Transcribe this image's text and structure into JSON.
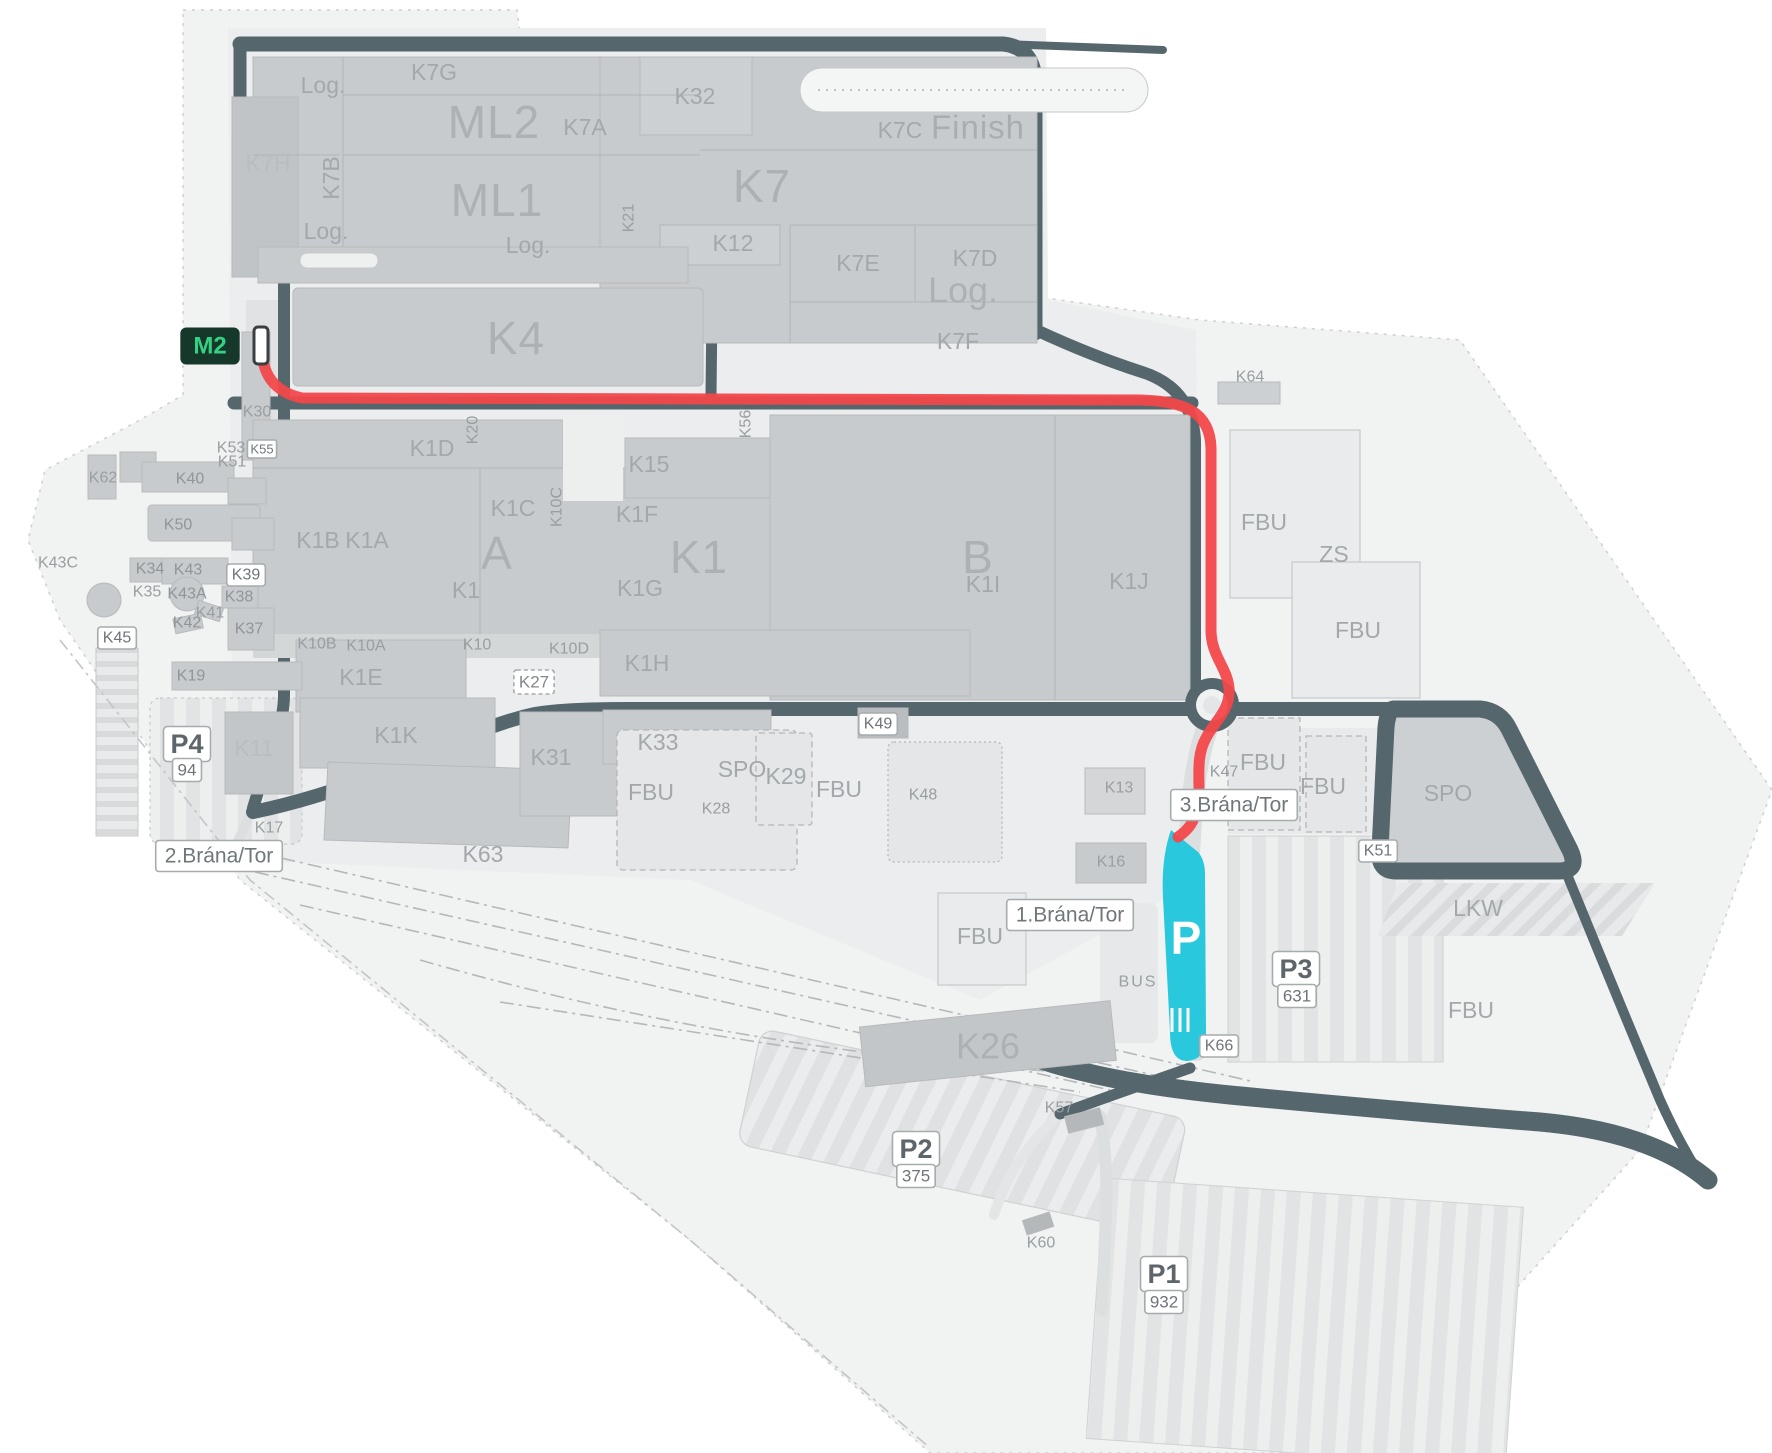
{
  "map": {
    "name": "factory-site-map",
    "colors": {
      "route_red": "#f2484b",
      "parking_cyan": "#29c8dd",
      "m2_badge_bg": "#16382b",
      "m2_badge_text": "#35d183",
      "road_dark": "#55666c",
      "building_gray": "#c8cbcd",
      "label_gray": "#9aa0a3"
    },
    "badges": {
      "station": "M2",
      "parking_letter": "P"
    },
    "gates": [
      "1.Brána/Tor",
      "2.Brána/Tor",
      "3.Brána/Tor"
    ],
    "parking_counts": {
      "P1": "932",
      "P2": "375",
      "P3": "631",
      "P4": "94"
    },
    "labels": [
      {
        "id": "label-log-topleft",
        "text": "Log.",
        "x": 323,
        "y": 85,
        "cls": "md"
      },
      {
        "id": "label-k7g",
        "text": "K7G",
        "x": 434,
        "y": 72,
        "cls": "md"
      },
      {
        "id": "label-ml2",
        "text": "ML2",
        "x": 494,
        "y": 122,
        "cls": "big"
      },
      {
        "id": "label-k7a",
        "text": "K7A",
        "x": 585,
        "y": 127,
        "cls": "md"
      },
      {
        "id": "label-k32",
        "text": "K32",
        "x": 695,
        "y": 96,
        "cls": "md"
      },
      {
        "id": "label-k7c",
        "text": "K7C",
        "x": 900,
        "y": 130,
        "cls": "md"
      },
      {
        "id": "label-finish",
        "text": "Finish",
        "x": 978,
        "y": 127,
        "cls": "finish"
      },
      {
        "id": "label-k7h",
        "text": "K7H",
        "x": 268,
        "y": 163,
        "cls": "mdl"
      },
      {
        "id": "label-k7b",
        "text": "K7B",
        "x": 331,
        "y": 178,
        "cls": "md",
        "rot": -90
      },
      {
        "id": "label-ml1",
        "text": "ML1",
        "x": 497,
        "y": 200,
        "cls": "big"
      },
      {
        "id": "label-k7",
        "text": "K7",
        "x": 762,
        "y": 186,
        "cls": "big"
      },
      {
        "id": "label-log-midleft",
        "text": "Log.",
        "x": 326,
        "y": 231,
        "cls": "md"
      },
      {
        "id": "label-log-center",
        "text": "Log.",
        "x": 528,
        "y": 245,
        "cls": "md"
      },
      {
        "id": "label-k21",
        "text": "K21",
        "x": 629,
        "y": 218,
        "cls": "sm",
        "rot": -90
      },
      {
        "id": "label-k12",
        "text": "K12",
        "x": 733,
        "y": 243,
        "cls": "md"
      },
      {
        "id": "label-k7e",
        "text": "K7E",
        "x": 858,
        "y": 263,
        "cls": "md"
      },
      {
        "id": "label-k7d",
        "text": "K7D",
        "x": 975,
        "y": 258,
        "cls": "md"
      },
      {
        "id": "label-log-k7d",
        "text": "Log.",
        "x": 963,
        "y": 290,
        "cls": "big2"
      },
      {
        "id": "label-k7f",
        "text": "K7F",
        "x": 958,
        "y": 341,
        "cls": "md"
      },
      {
        "id": "badge-m2",
        "text": "M2",
        "x": 210,
        "y": 346,
        "cls": "m2"
      },
      {
        "id": "label-k4",
        "text": "K4",
        "x": 516,
        "y": 338,
        "cls": "big"
      },
      {
        "id": "label-k30",
        "text": "K30",
        "x": 257,
        "y": 412,
        "cls": "sm"
      },
      {
        "id": "label-k53",
        "text": "K53",
        "x": 231,
        "y": 448,
        "cls": "sm"
      },
      {
        "id": "label-k55",
        "text": "K55",
        "x": 262,
        "y": 449,
        "cls": "pillTiny"
      },
      {
        "id": "label-k51-left",
        "text": "K51",
        "x": 232,
        "y": 462,
        "cls": "sm"
      },
      {
        "id": "label-k64",
        "text": "K64",
        "x": 1250,
        "y": 377,
        "cls": "sm"
      },
      {
        "id": "label-k1d",
        "text": "K1D",
        "x": 432,
        "y": 448,
        "cls": "md"
      },
      {
        "id": "label-k20",
        "text": "K20",
        "x": 473,
        "y": 430,
        "cls": "sm",
        "rot": -90
      },
      {
        "id": "label-k15",
        "text": "K15",
        "x": 649,
        "y": 464,
        "cls": "md"
      },
      {
        "id": "label-k56",
        "text": "K56",
        "x": 746,
        "y": 424,
        "cls": "sm",
        "rot": -90
      },
      {
        "id": "label-k1b",
        "text": "K1B",
        "x": 318,
        "y": 540,
        "cls": "md"
      },
      {
        "id": "label-k1a",
        "text": "K1A",
        "x": 367,
        "y": 540,
        "cls": "md"
      },
      {
        "id": "label-k1c",
        "text": "K1C",
        "x": 513,
        "y": 508,
        "cls": "md"
      },
      {
        "id": "label-k10c",
        "text": "K10C",
        "x": 557,
        "y": 507,
        "cls": "sm",
        "rot": -90
      },
      {
        "id": "label-k1f",
        "text": "K1F",
        "x": 637,
        "y": 514,
        "cls": "md"
      },
      {
        "id": "label-a",
        "text": "A",
        "x": 497,
        "y": 553,
        "cls": "big"
      },
      {
        "id": "label-k1-sub",
        "text": "K1",
        "x": 466,
        "y": 590,
        "cls": "md"
      },
      {
        "id": "label-k1-big",
        "text": "K1",
        "x": 699,
        "y": 557,
        "cls": "big"
      },
      {
        "id": "label-k1g",
        "text": "K1G",
        "x": 640,
        "y": 588,
        "cls": "md"
      },
      {
        "id": "label-b",
        "text": "B",
        "x": 978,
        "y": 557,
        "cls": "big"
      },
      {
        "id": "label-k1i",
        "text": "K1I",
        "x": 983,
        "y": 584,
        "cls": "md"
      },
      {
        "id": "label-k1j",
        "text": "K1J",
        "x": 1129,
        "y": 581,
        "cls": "md"
      },
      {
        "id": "label-k10b",
        "text": "K10B",
        "x": 317,
        "y": 644,
        "cls": "sm"
      },
      {
        "id": "label-k10a",
        "text": "K10A",
        "x": 366,
        "y": 646,
        "cls": "sm"
      },
      {
        "id": "label-k10",
        "text": "K10",
        "x": 477,
        "y": 645,
        "cls": "sm"
      },
      {
        "id": "label-k10d",
        "text": "K10D",
        "x": 569,
        "y": 649,
        "cls": "sm"
      },
      {
        "id": "label-k1h",
        "text": "K1H",
        "x": 647,
        "y": 663,
        "cls": "md"
      },
      {
        "id": "label-k1e",
        "text": "K1E",
        "x": 361,
        "y": 677,
        "cls": "md"
      },
      {
        "id": "label-k27",
        "text": "K27",
        "x": 534,
        "y": 682,
        "cls": "pillDash"
      },
      {
        "id": "label-k1k",
        "text": "K1K",
        "x": 396,
        "y": 735,
        "cls": "md"
      },
      {
        "id": "label-k62",
        "text": "K62",
        "x": 103,
        "y": 478,
        "cls": "sm"
      },
      {
        "id": "label-k40",
        "text": "K40",
        "x": 190,
        "y": 479,
        "cls": "smD"
      },
      {
        "id": "label-k50",
        "text": "K50",
        "x": 178,
        "y": 525,
        "cls": "smD"
      },
      {
        "id": "label-k43c",
        "text": "K43C",
        "x": 58,
        "y": 563,
        "cls": "sm"
      },
      {
        "id": "label-k34",
        "text": "K34",
        "x": 150,
        "y": 569,
        "cls": "smD"
      },
      {
        "id": "label-k43",
        "text": "K43",
        "x": 188,
        "y": 570,
        "cls": "smD"
      },
      {
        "id": "label-k35",
        "text": "K35",
        "x": 147,
        "y": 592,
        "cls": "sm"
      },
      {
        "id": "label-k43a",
        "text": "K43A",
        "x": 187,
        "y": 594,
        "cls": "smD"
      },
      {
        "id": "label-k39",
        "text": "K39",
        "x": 246,
        "y": 575,
        "cls": "pillSm"
      },
      {
        "id": "label-k38",
        "text": "K38",
        "x": 239,
        "y": 597,
        "cls": "smD"
      },
      {
        "id": "label-k41",
        "text": "K41",
        "x": 210,
        "y": 613,
        "cls": "sm"
      },
      {
        "id": "label-k42",
        "text": "K42",
        "x": 187,
        "y": 623,
        "cls": "smD"
      },
      {
        "id": "label-k37",
        "text": "K37",
        "x": 249,
        "y": 629,
        "cls": "smD"
      },
      {
        "id": "label-k45",
        "text": "K45",
        "x": 117,
        "y": 638,
        "cls": "pillSm"
      },
      {
        "id": "label-k19",
        "text": "K19",
        "x": 191,
        "y": 676,
        "cls": "smD"
      },
      {
        "id": "label-p4",
        "text": "P4",
        "x": 187,
        "y": 744,
        "cls": "pillBig"
      },
      {
        "id": "label-p4-count",
        "text": "94",
        "x": 187,
        "y": 770,
        "cls": "pillNum"
      },
      {
        "id": "label-k11",
        "text": "K11",
        "x": 254,
        "y": 748,
        "cls": "mdl"
      },
      {
        "id": "label-k17",
        "text": "K17",
        "x": 269,
        "y": 828,
        "cls": "sm"
      },
      {
        "id": "gate-2-brana-tor",
        "text": "2.Brána/Tor",
        "x": 219,
        "y": 856,
        "cls": "gate"
      },
      {
        "id": "label-k31",
        "text": "K31",
        "x": 551,
        "y": 757,
        "cls": "md"
      },
      {
        "id": "label-k33",
        "text": "K33",
        "x": 658,
        "y": 742,
        "cls": "md"
      },
      {
        "id": "label-spo-center",
        "text": "SPO",
        "x": 742,
        "y": 769,
        "cls": "md"
      },
      {
        "id": "label-k29",
        "text": "K29",
        "x": 786,
        "y": 776,
        "cls": "md"
      },
      {
        "id": "label-fbu-1",
        "text": "FBU",
        "x": 651,
        "y": 792,
        "cls": "md"
      },
      {
        "id": "label-k28",
        "text": "K28",
        "x": 716,
        "y": 809,
        "cls": "sm"
      },
      {
        "id": "label-fbu-2",
        "text": "FBU",
        "x": 839,
        "y": 789,
        "cls": "md"
      },
      {
        "id": "label-k48",
        "text": "K48",
        "x": 923,
        "y": 795,
        "cls": "sm"
      },
      {
        "id": "label-k49",
        "text": "K49",
        "x": 878,
        "y": 724,
        "cls": "pillSm"
      },
      {
        "id": "label-k63",
        "text": "K63",
        "x": 483,
        "y": 854,
        "cls": "md"
      },
      {
        "id": "label-fbu-3",
        "text": "FBU",
        "x": 980,
        "y": 936,
        "cls": "md"
      },
      {
        "id": "label-k26",
        "text": "K26",
        "x": 988,
        "y": 1046,
        "cls": "big2"
      },
      {
        "id": "gate-1-brana-tor",
        "text": "1.Brána/Tor",
        "x": 1070,
        "y": 915,
        "cls": "gate"
      },
      {
        "id": "label-k16",
        "text": "K16",
        "x": 1111,
        "y": 862,
        "cls": "sm"
      },
      {
        "id": "label-k13",
        "text": "K13",
        "x": 1119,
        "y": 788,
        "cls": "sm"
      },
      {
        "id": "label-bus",
        "text": "BUS",
        "x": 1138,
        "y": 982,
        "cls": "bus"
      },
      {
        "id": "label-parking-p",
        "text": "P",
        "x": 1186,
        "y": 938,
        "cls": "pcyan"
      },
      {
        "id": "label-k66",
        "text": "K66",
        "x": 1219,
        "y": 1046,
        "cls": "pillSm"
      },
      {
        "id": "gate-3-brana-tor",
        "text": "3.Brána/Tor",
        "x": 1234,
        "y": 805,
        "cls": "gate"
      },
      {
        "id": "label-k47",
        "text": "K47",
        "x": 1224,
        "y": 772,
        "cls": "sm"
      },
      {
        "id": "label-k57",
        "text": "K57",
        "x": 1059,
        "y": 1108,
        "cls": "sm"
      },
      {
        "id": "label-p2",
        "text": "P2",
        "x": 916,
        "y": 1149,
        "cls": "pillBig"
      },
      {
        "id": "label-p2-count",
        "text": "375",
        "x": 916,
        "y": 1176,
        "cls": "pillNum"
      },
      {
        "id": "label-k60",
        "text": "K60",
        "x": 1041,
        "y": 1243,
        "cls": "sm"
      },
      {
        "id": "label-p1",
        "text": "P1",
        "x": 1164,
        "y": 1274,
        "cls": "pillBig"
      },
      {
        "id": "label-p1-count",
        "text": "932",
        "x": 1164,
        "y": 1302,
        "cls": "pillNum"
      },
      {
        "id": "label-p3",
        "text": "P3",
        "x": 1296,
        "y": 969,
        "cls": "pillBig"
      },
      {
        "id": "label-p3-count",
        "text": "631",
        "x": 1297,
        "y": 996,
        "cls": "pillNum"
      },
      {
        "id": "label-fbu-4",
        "text": "FBU",
        "x": 1264,
        "y": 522,
        "cls": "md"
      },
      {
        "id": "label-zs",
        "text": "ZS",
        "x": 1334,
        "y": 554,
        "cls": "md"
      },
      {
        "id": "label-fbu-5",
        "text": "FBU",
        "x": 1358,
        "y": 630,
        "cls": "md"
      },
      {
        "id": "label-fbu-6",
        "text": "FBU",
        "x": 1263,
        "y": 762,
        "cls": "md"
      },
      {
        "id": "label-fbu-7",
        "text": "FBU",
        "x": 1323,
        "y": 786,
        "cls": "md"
      },
      {
        "id": "label-k51-right",
        "text": "K51",
        "x": 1378,
        "y": 851,
        "cls": "pillSm"
      },
      {
        "id": "label-spo-right",
        "text": "SPO",
        "x": 1448,
        "y": 793,
        "cls": "md"
      },
      {
        "id": "label-lkw",
        "text": "LKW",
        "x": 1478,
        "y": 908,
        "cls": "md"
      },
      {
        "id": "label-fbu-8",
        "text": "FBU",
        "x": 1471,
        "y": 1010,
        "cls": "md"
      }
    ]
  }
}
